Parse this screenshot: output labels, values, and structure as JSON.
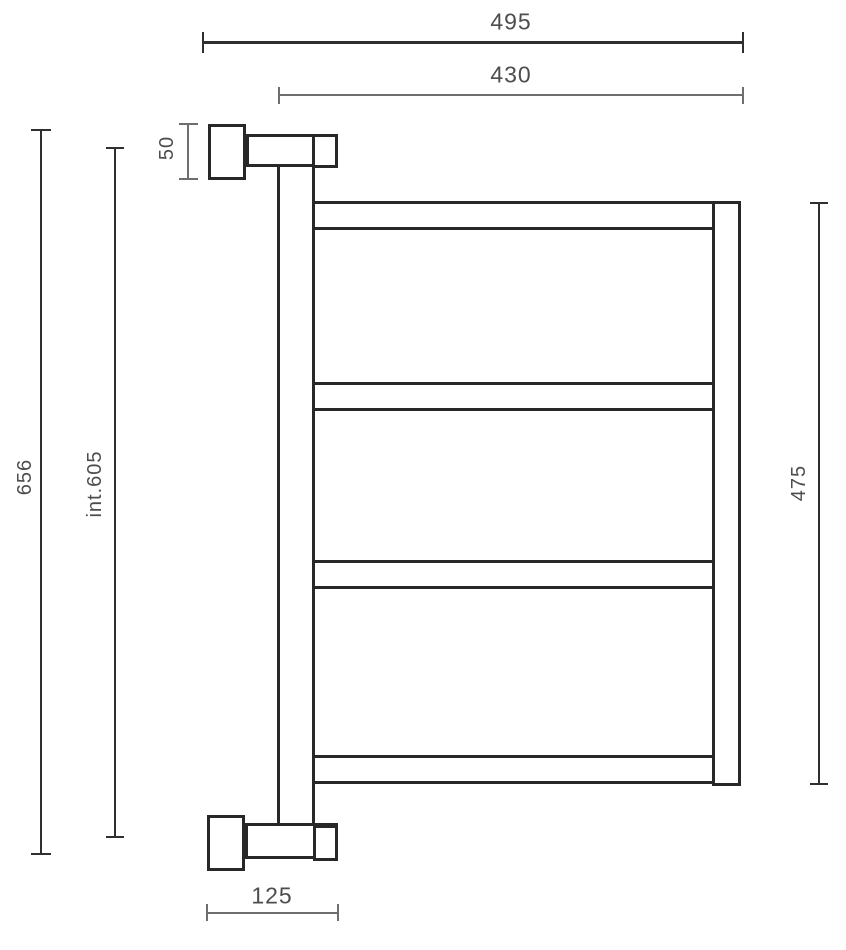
{
  "drawing": {
    "kind": "technical-dimension-drawing",
    "subject": "wall-mounted towel rail side elevation"
  },
  "colors": {
    "background": "#ffffff",
    "outline": "#282828",
    "dim_line": "#6e6e6e",
    "dim_line_strong": "#2f2f2f",
    "text": "#4d4d4d"
  },
  "dimensions": {
    "overall_width": {
      "label": "495"
    },
    "inner_width": {
      "label": "430"
    },
    "bracket_height": {
      "label": "50"
    },
    "overall_height": {
      "label": "656"
    },
    "internal_height": {
      "label": "int.605"
    },
    "body_height": {
      "label": "475"
    },
    "bracket_depth": {
      "label": "125"
    }
  }
}
